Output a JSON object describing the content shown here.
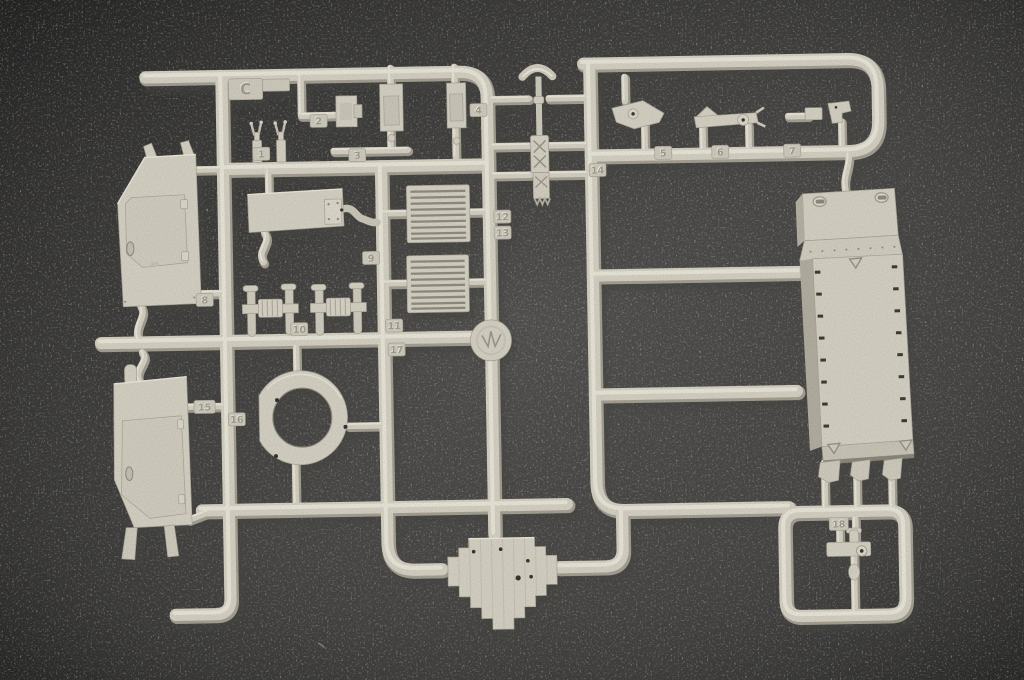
{
  "scene": {
    "colors": {
      "felt": "#4b4a48",
      "plastic_base": "#d5d1c3",
      "plastic_shade": "#a49f91",
      "plastic_highlight": "#edeadd",
      "plastic_recess": "#8f8b7e",
      "hole": "#34332f"
    }
  },
  "sprue": {
    "letter": "C",
    "part_numbers": [
      "1",
      "2",
      "3",
      "4",
      "5",
      "6",
      "7",
      "8",
      "9",
      "10",
      "11",
      "12",
      "13",
      "14",
      "15",
      "16",
      "17",
      "18"
    ]
  }
}
